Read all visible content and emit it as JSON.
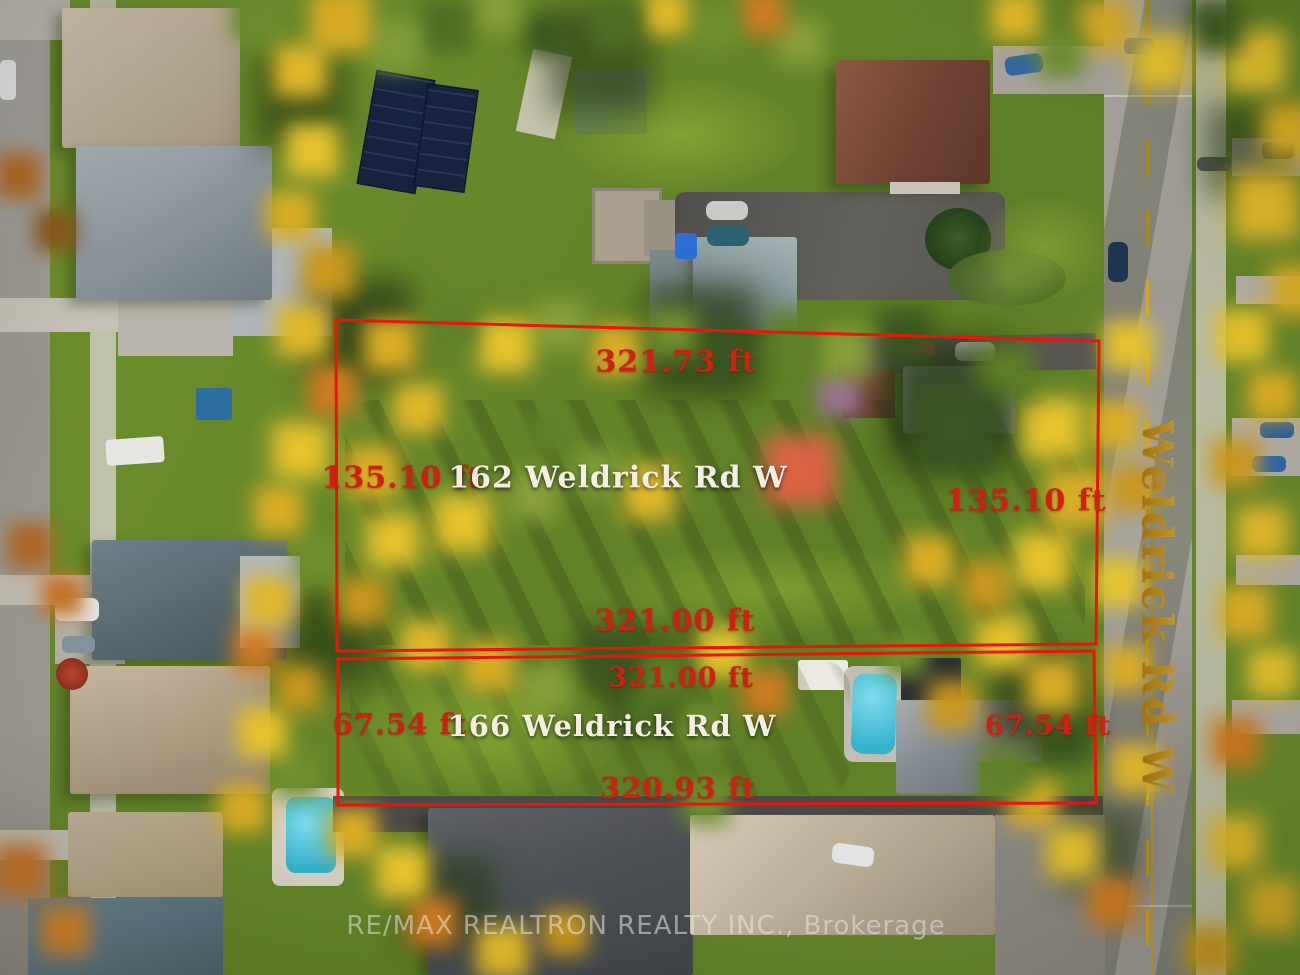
{
  "photo": {
    "description": "Aerial drone view of two treed lots outlined in red on Weldrick Rd W",
    "street_label": "Weldrick Rd W",
    "watermark": "RE/MAX REALTRON REALTY INC., Brokerage"
  },
  "parcels": [
    {
      "address": "162 Weldrick Rd W",
      "frontage_top": "321.73 ft",
      "side_left": "135.10 ft",
      "side_right": "135.10 ft",
      "rear_bottom": "321.00 ft"
    },
    {
      "address": "166 Weldrick Rd W",
      "frontage_top": "321.00 ft",
      "side_left": "67.54 ft",
      "side_right": "67.54 ft",
      "rear_bottom": "320.93 ft"
    }
  ],
  "colors": {
    "boundary_red": "#ea1508",
    "measurement_red": "#ce2013",
    "address_white": "#f3efe4",
    "street_gold": "#d9a427"
  }
}
